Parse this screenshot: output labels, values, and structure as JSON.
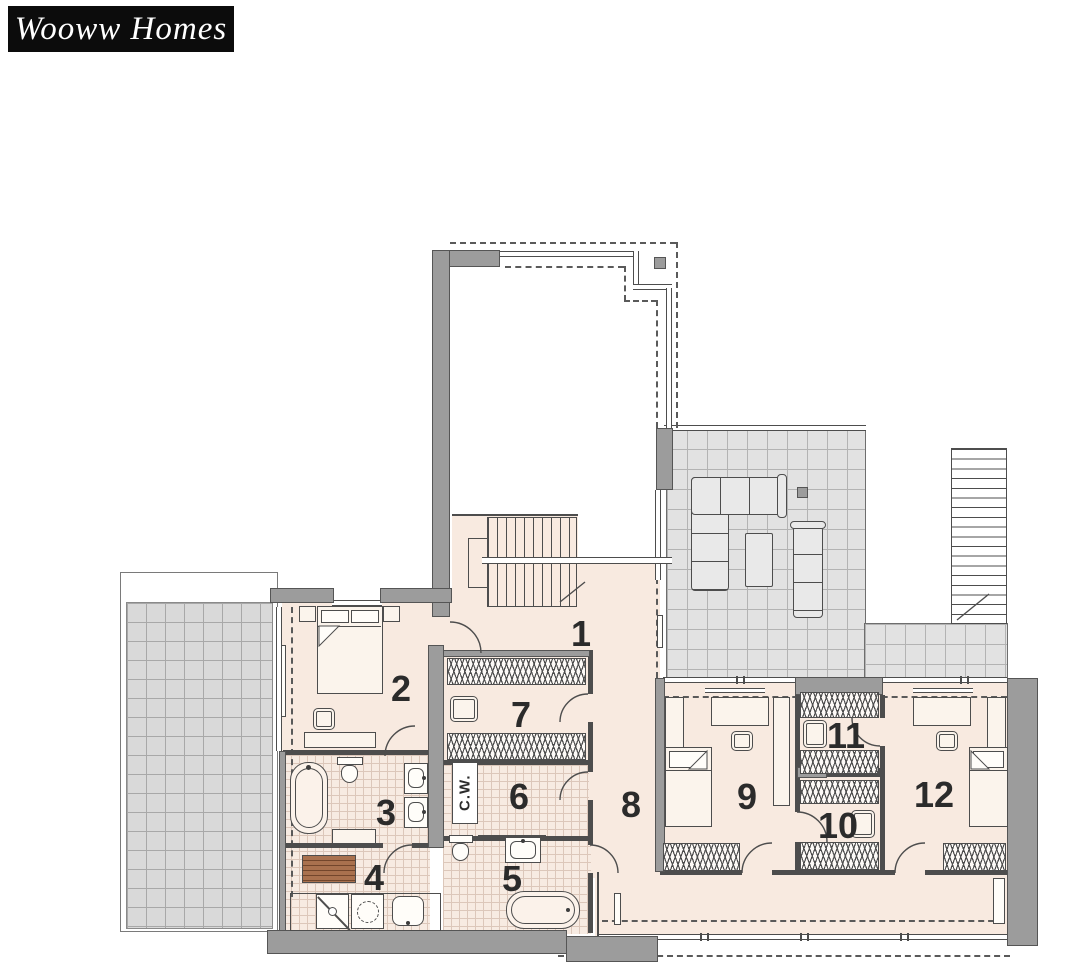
{
  "logo": {
    "text": "Wooww Homes"
  },
  "plan": {
    "type": "floor-plan",
    "room_numbers": [
      "1",
      "2",
      "3",
      "4",
      "5",
      "6",
      "7",
      "8",
      "9",
      "10",
      "11",
      "12"
    ],
    "labels": {
      "cold_water_closet": "C.W."
    },
    "colors": {
      "floor": "#f8eae0",
      "wall": "#9c9c9c",
      "line": "#4d4d4d",
      "terrace_tile": "#e2e2e2",
      "left_terrace_tile": "#d9d9d9",
      "tile_grout": "#dcc7ba",
      "wood_bench": "#a9714e",
      "logo_bg": "#0c0c0c",
      "logo_text": "#ffffff"
    }
  }
}
